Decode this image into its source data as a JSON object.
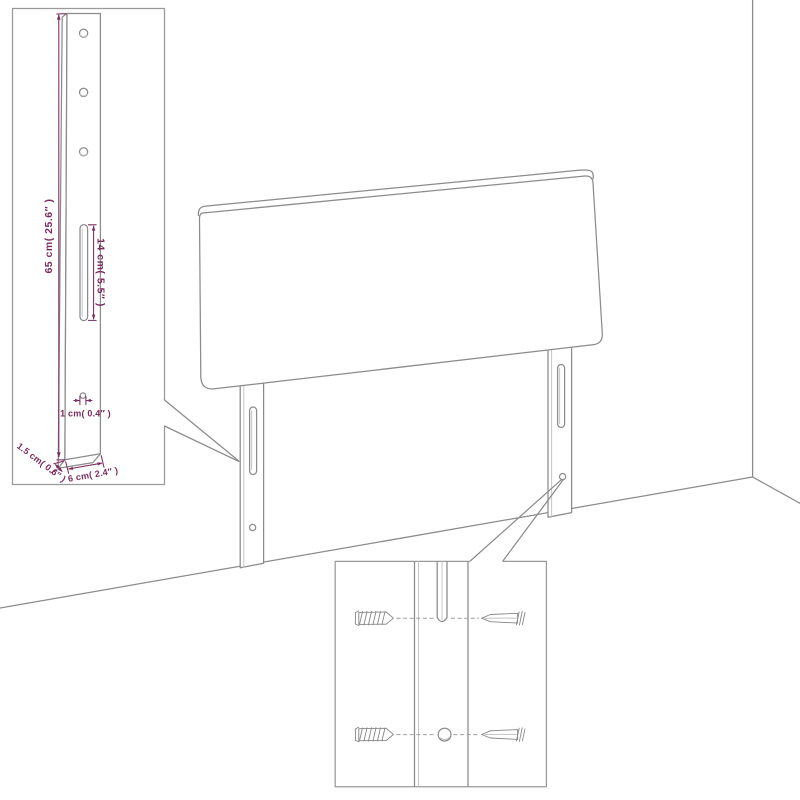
{
  "colors": {
    "dimension_accent": "#7C2B5E",
    "line_art": "#8B8B8B"
  },
  "leg_detail_inset": {
    "dim_height": "65 cm( 25.6″ )",
    "dim_slot_length": "14 cm( 5.5″ )",
    "dim_hole": "1 cm( 0.4″ )",
    "dim_thickness": "1.5 cm( 0.6″ )",
    "dim_width": "6 cm( 2.4″ )"
  }
}
